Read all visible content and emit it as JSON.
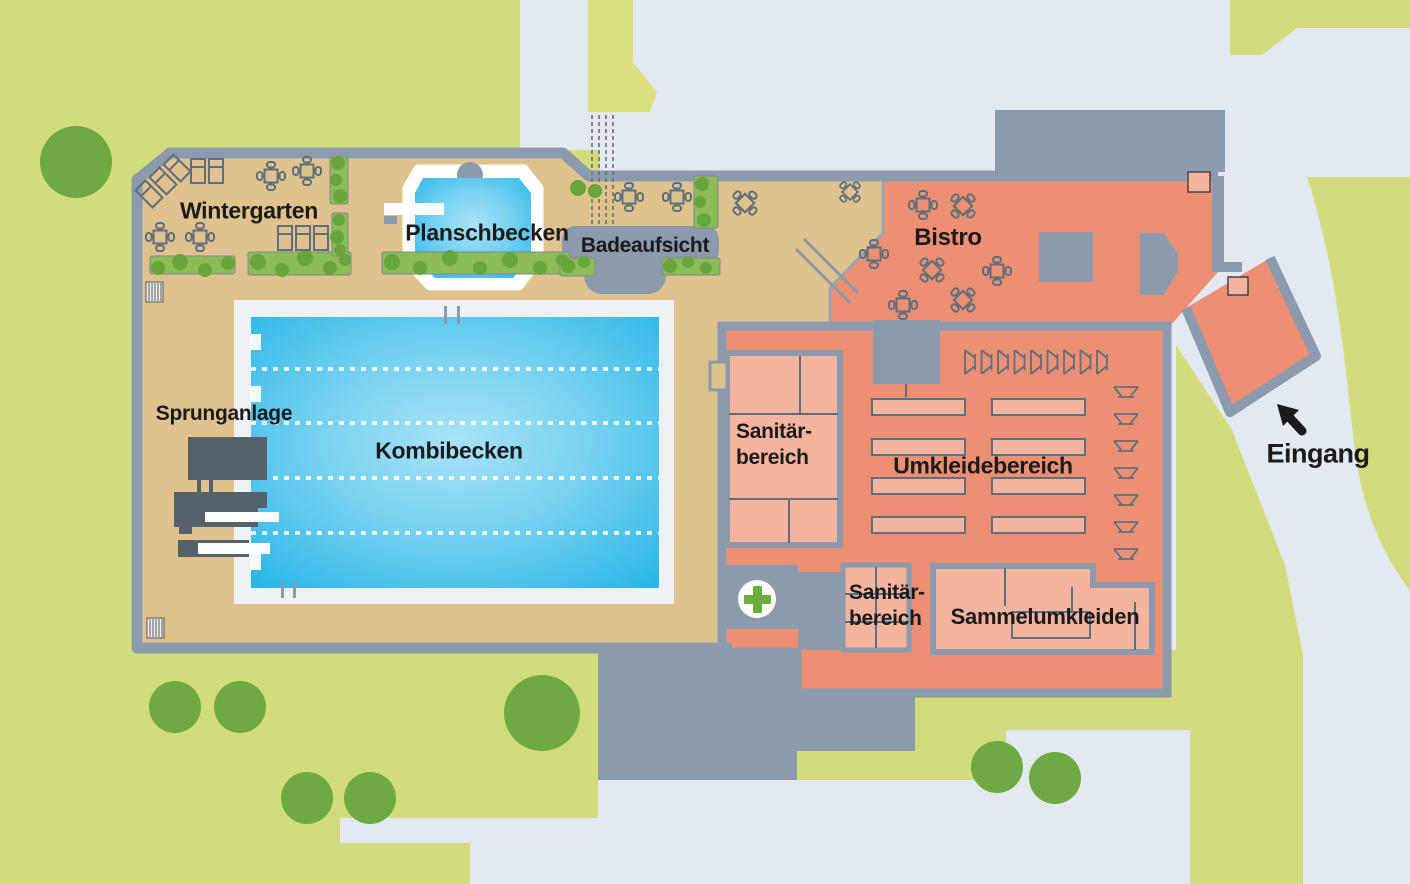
{
  "map": {
    "labels": {
      "wintergarten": "Wintergarten",
      "planschbecken": "Planschbecken",
      "badeaufsicht": "Badeaufsicht",
      "bistro": "Bistro",
      "sprunganlage": "Sprunganlage",
      "kombibecken": "Kombibecken",
      "umkleidebereich": "Umkleidebereich",
      "sammelumkleiden": "Sammelumkleiden",
      "eingang": "Eingang"
    },
    "sanitary_pool": {
      "line1": "Sanitär-",
      "line2": "bereich"
    },
    "sanitary_entry": {
      "line1": "Sanitär-",
      "line2": "bereich"
    },
    "colors": {
      "lawn": "#D3DC7C",
      "tree": "#6FA944",
      "path": "#E3E9F0",
      "wall": "#8C9AAD",
      "deck": "#DFC28E",
      "building": "#EC8F72",
      "room": "#F4B49D",
      "pool_edge": "#2AB6E7",
      "pool_center": "#A9E3F7",
      "pool_frame": "#EEF2F7",
      "dark_fixture": "#55626C",
      "first_aid_green": "#6BAE3A",
      "hedge": "#8CBC55",
      "hedge_blob": "#68A53C",
      "label_text": "#1B1B1B",
      "arrow": "#1A1A1A"
    },
    "icons": {
      "first_aid": "green-cross-in-white-circle",
      "entrance_arrow": "arrow-up-left",
      "furniture": [
        "table-with-chairs",
        "lounger",
        "changing-cabin",
        "hedge",
        "tree",
        "grate"
      ]
    }
  }
}
